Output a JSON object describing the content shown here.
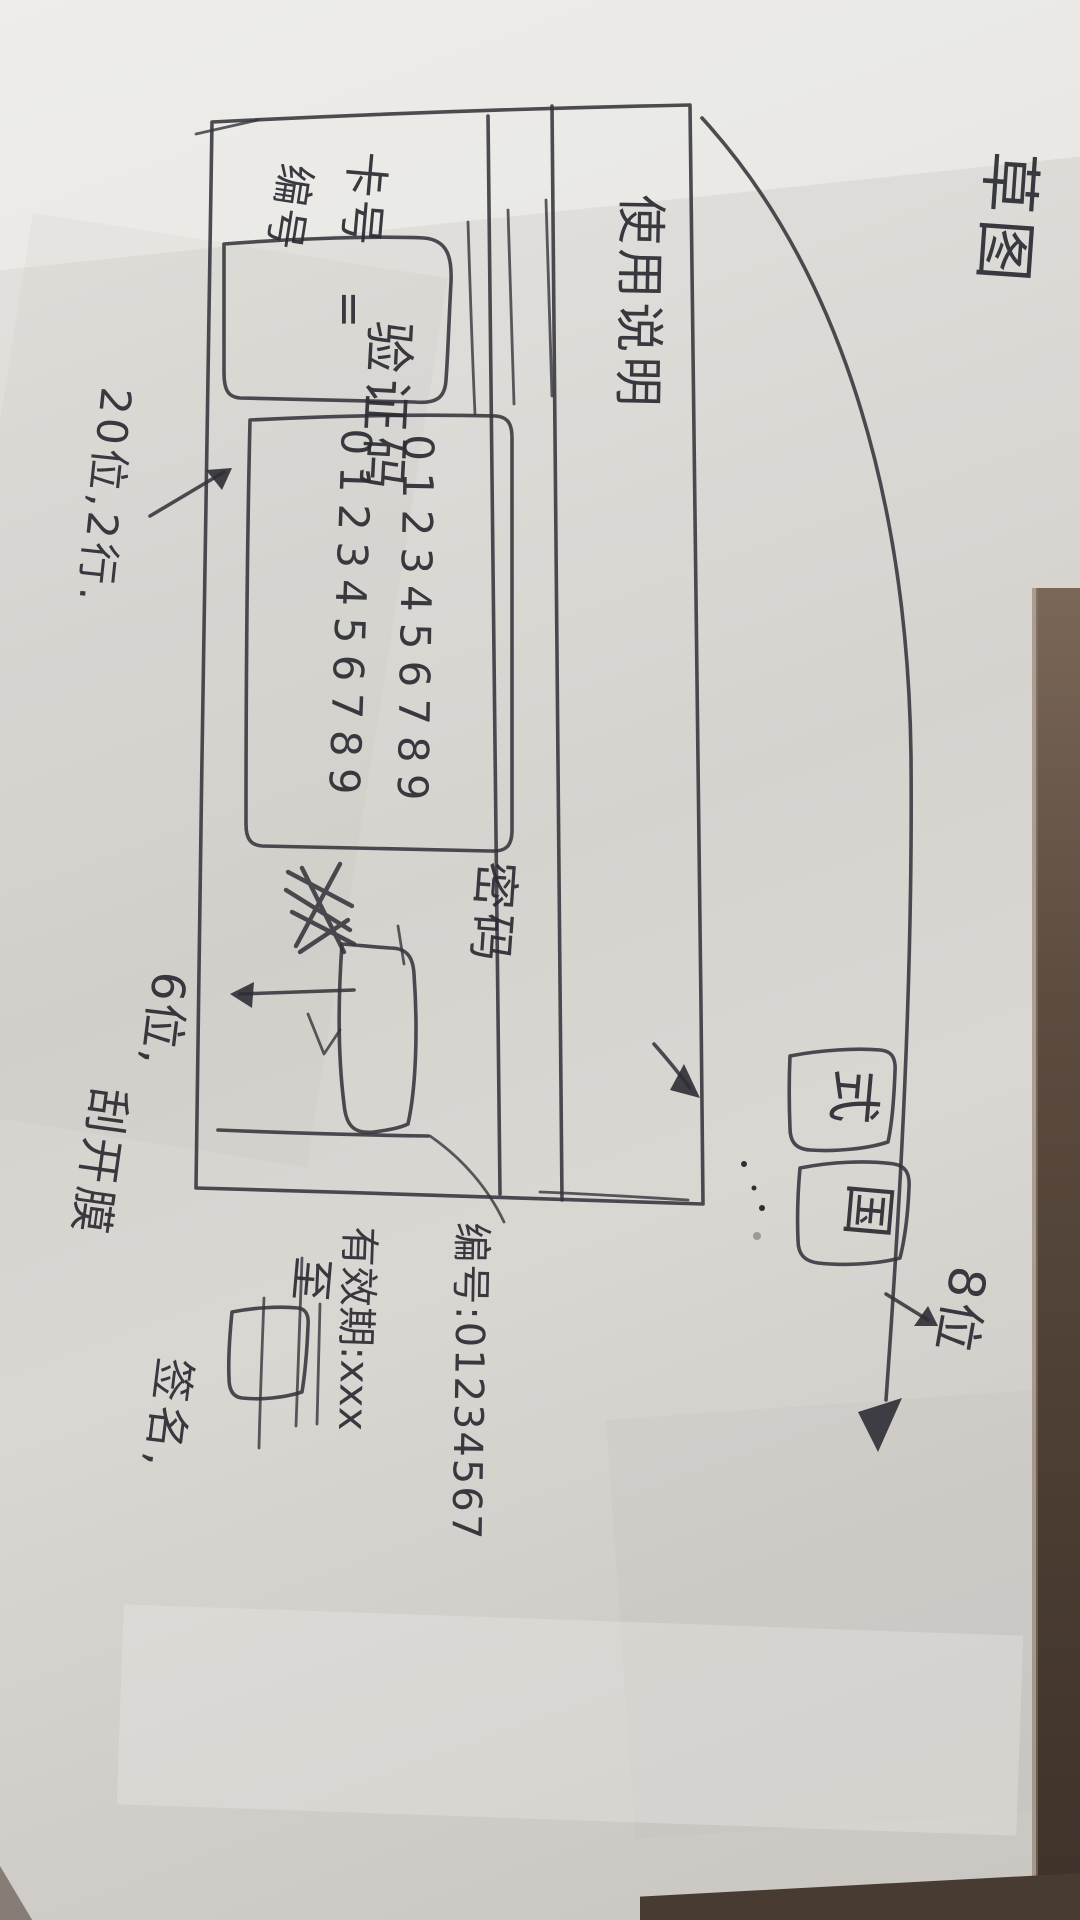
{
  "meta": {
    "description": "Photo of a hand-drawn UI wireframe sketch (scratch/recharge card design) on paper, rotated 90 degrees"
  },
  "annotations": {
    "sketch_label": "草图",
    "digits_note": "20位,2行.",
    "scratch_note_line1": "6位,",
    "scratch_note_line2": "刮开膜",
    "serial_note": "编号:01234567",
    "serial_digits_note": "8位",
    "validity": "有效期:xxx",
    "until": "至",
    "signature": "签名,"
  },
  "card": {
    "instructions_title": "使用说明",
    "number_label_a": "卡号",
    "number_label_b": "编号",
    "equals": "=",
    "verification_label": "验证码",
    "digits_row1": "0123456789",
    "digits_row2": "0123456789",
    "password_label": "密码",
    "chip1": "式",
    "chip2": "国"
  },
  "colors": {
    "ink": "#35343b",
    "paper": "#dbd9d5",
    "table": "#53443a"
  }
}
